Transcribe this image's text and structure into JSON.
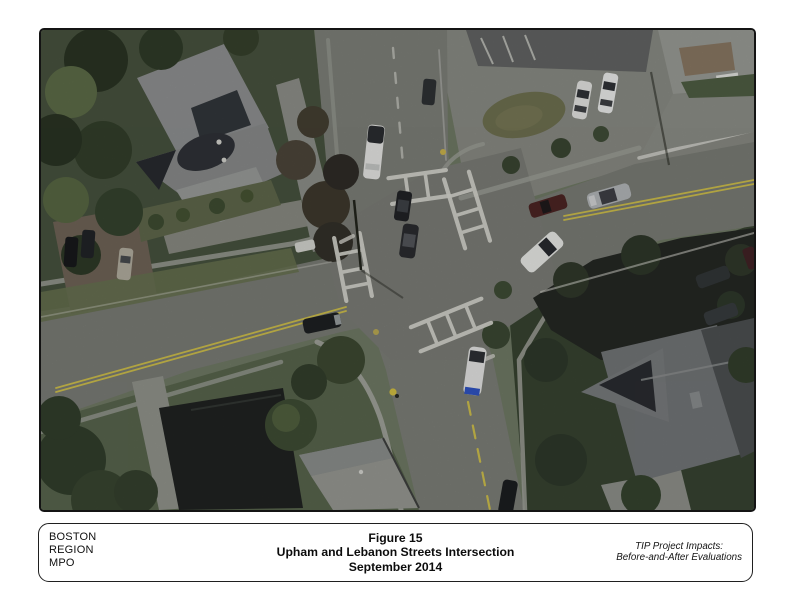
{
  "footer": {
    "org_lines": [
      "BOSTON",
      "REGION",
      "MPO"
    ],
    "title_lines": [
      "Figure 15",
      "Upham and Lebanon Streets Intersection",
      "September 2014"
    ],
    "note_lines": [
      "TIP Project Impacts:",
      "Before-and-After Evaluations"
    ]
  },
  "photo": {
    "palette": {
      "road": "#7a7c75",
      "crosswalk_white": "#dcdcd4",
      "centerline_yellow": "#d2c24a",
      "tree_dark": "#2b3724",
      "grass": "#65724e",
      "roof_gray": "#8f9192",
      "roof_dark": "#22251f",
      "car_white": "#efefec",
      "car_silver": "#b7babc",
      "car_maroon": "#49201f",
      "car_blue_accent": "#2b52c8"
    }
  }
}
